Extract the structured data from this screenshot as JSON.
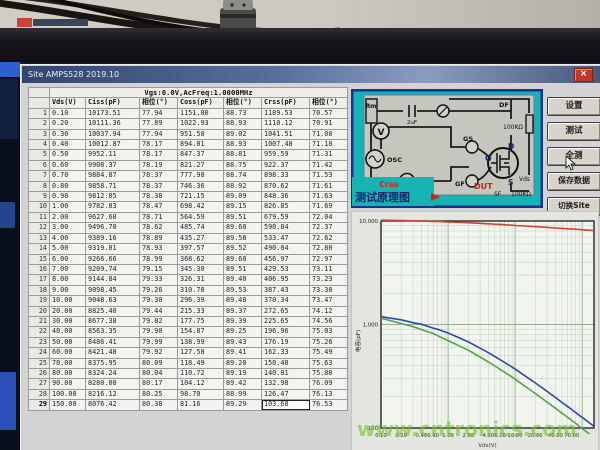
{
  "window": {
    "title": "Site AMPS528 2019.10",
    "close_label": "×"
  },
  "table": {
    "condition_header": "Vgs:0.0V,AcFreq:1.0000MHz",
    "columns": [
      "Vds(V)",
      "Ciss(pF)",
      "相位(°)",
      "Coss(pF)",
      "相位(°)",
      "Crss(pF)",
      "相位(°)"
    ],
    "rows": [
      [
        "0.10",
        "10173.51",
        "77.94",
        "1151.00",
        "88.73",
        "1189.53",
        "70.57"
      ],
      [
        "0.20",
        "10111.36",
        "77.89",
        "1022.93",
        "88.93",
        "1110.12",
        "70.91"
      ],
      [
        "0.30",
        "10037.94",
        "77.94",
        "951.58",
        "89.02",
        "1041.51",
        "71.08"
      ],
      [
        "0.40",
        "10012.87",
        "78.17",
        "894.01",
        "88.93",
        "1007.48",
        "71.18"
      ],
      [
        "0.50",
        "9952.11",
        "78.17",
        "847.37",
        "88.81",
        "959.59",
        "71.31"
      ],
      [
        "0.60",
        "9908.37",
        "78.19",
        "821.27",
        "88.75",
        "922.37",
        "71.42"
      ],
      [
        "0.70",
        "9884.87",
        "78.37",
        "777.98",
        "88.74",
        "898.33",
        "71.53"
      ],
      [
        "0.80",
        "9858.71",
        "78.37",
        "746.36",
        "88.92",
        "870.62",
        "71.61"
      ],
      [
        "0.90",
        "9812.05",
        "78.38",
        "721.15",
        "89.09",
        "848.36",
        "71.63"
      ],
      [
        "1.00",
        "9782.83",
        "78.47",
        "698.42",
        "89.15",
        "826.85",
        "71.69"
      ],
      [
        "2.00",
        "9627.68",
        "78.71",
        "564.59",
        "89.51",
        "679.59",
        "72.04"
      ],
      [
        "3.00",
        "9496.70",
        "78.62",
        "485.74",
        "89.60",
        "590.84",
        "72.37"
      ],
      [
        "4.00",
        "9389.16",
        "78.89",
        "435.27",
        "89.58",
        "533.47",
        "72.62"
      ],
      [
        "5.00",
        "9319.81",
        "78.93",
        "397.57",
        "89.52",
        "490.04",
        "72.80"
      ],
      [
        "6.00",
        "9266.66",
        "78.99",
        "368.62",
        "89.60",
        "456.97",
        "72.97"
      ],
      [
        "7.00",
        "9209.74",
        "79.15",
        "345.30",
        "89.51",
        "429.53",
        "73.11"
      ],
      [
        "8.00",
        "9144.84",
        "79.33",
        "326.31",
        "89.40",
        "406.95",
        "73.23"
      ],
      [
        "9.00",
        "9098.45",
        "79.26",
        "310.70",
        "89.53",
        "387.43",
        "73.38"
      ],
      [
        "10.00",
        "9048.63",
        "79.30",
        "296.39",
        "89.48",
        "370.34",
        "73.47"
      ],
      [
        "20.00",
        "8825.40",
        "79.44",
        "215.33",
        "89.37",
        "272.65",
        "74.12"
      ],
      [
        "30.00",
        "8677.38",
        "79.82",
        "177.75",
        "89.39",
        "225.65",
        "74.56"
      ],
      [
        "40.00",
        "8563.35",
        "79.90",
        "154.87",
        "89.25",
        "196.96",
        "75.03"
      ],
      [
        "50.00",
        "8486.41",
        "79.99",
        "138.99",
        "89.43",
        "176.19",
        "75.26"
      ],
      [
        "60.00",
        "8421.48",
        "79.92",
        "127.58",
        "89.41",
        "162.33",
        "75.49"
      ],
      [
        "70.00",
        "8375.95",
        "80.09",
        "118.49",
        "89.20",
        "150.48",
        "75.63"
      ],
      [
        "80.00",
        "8324.24",
        "80.04",
        "110.72",
        "89.19",
        "140.81",
        "75.88"
      ],
      [
        "90.00",
        "8280.08",
        "80.17",
        "104.12",
        "89.42",
        "132.98",
        "76.09"
      ],
      [
        "100.00",
        "8216.12",
        "80.25",
        "98.70",
        "88.99",
        "126.47",
        "76.13"
      ],
      [
        "150.00",
        "8076.42",
        "80.38",
        "81.16",
        "89.29",
        "103.68",
        "76.53"
      ]
    ],
    "selected_cell": {
      "row": 29,
      "column": "Crss(pF)"
    }
  },
  "buttons": {
    "settings": "设置",
    "test": "测试",
    "test_all": "全测",
    "save_data": "保存数据",
    "switch_site": "切换Site"
  },
  "diagram": {
    "caption_series": "Crss",
    "caption": "测试原理图",
    "labels": {
      "rm": "Rm",
      "cap": "2uF",
      "df": "DF",
      "r_top": "100KΩ",
      "osc": "OSC",
      "v_meter": "V",
      "a_meter": "A",
      "gs": "GS",
      "g": "G",
      "gf": "GF",
      "dut": "DUT",
      "d": "D",
      "s": "S",
      "vds": "Vds",
      "sf": "SF",
      "r_bottom": "100KΩ"
    },
    "colors": {
      "panel": "#15b3b3",
      "border": "#16338f",
      "dut_text": "#d42315"
    }
  },
  "chart_data": {
    "type": "line",
    "x": [
      0.1,
      0.2,
      0.3,
      0.4,
      0.5,
      0.6,
      0.7,
      0.8,
      0.9,
      1,
      2,
      3,
      4,
      5,
      6,
      7,
      8,
      9,
      10,
      20,
      30,
      40,
      50,
      60,
      70,
      80,
      90,
      100,
      150
    ],
    "series": [
      {
        "name": "Ciss",
        "color": "#c94438",
        "values": [
          10173.51,
          10111.36,
          10037.94,
          10012.87,
          9952.11,
          9908.37,
          9884.87,
          9858.71,
          9812.05,
          9782.83,
          9627.68,
          9496.7,
          9389.16,
          9319.81,
          9266.66,
          9209.74,
          9144.84,
          9098.45,
          9048.63,
          8825.4,
          8677.38,
          8563.35,
          8486.41,
          8421.48,
          8375.95,
          8324.24,
          8280.08,
          8216.12,
          8076.42
        ]
      },
      {
        "name": "Crss",
        "color": "#3545ae",
        "values": [
          1189.53,
          1110.12,
          1041.51,
          1007.48,
          959.59,
          922.37,
          898.33,
          870.62,
          848.36,
          826.85,
          679.59,
          590.84,
          533.47,
          490.04,
          456.97,
          429.53,
          406.95,
          387.43,
          370.34,
          272.65,
          225.65,
          196.96,
          176.19,
          162.33,
          150.48,
          140.81,
          132.98,
          126.47,
          103.68
        ]
      },
      {
        "name": "Coss",
        "color": "#55a24a",
        "values": [
          1151.0,
          1022.93,
          951.58,
          894.01,
          847.37,
          821.27,
          777.98,
          746.36,
          721.15,
          698.42,
          564.59,
          485.74,
          435.27,
          397.57,
          368.62,
          345.3,
          326.31,
          310.7,
          296.39,
          215.33,
          177.75,
          154.87,
          138.99,
          127.58,
          118.49,
          110.72,
          104.12,
          98.7,
          81.16
        ]
      }
    ],
    "xlabel": "Vds(V)",
    "ylabel": "电容(pF)",
    "xscale": "log",
    "yscale": "log",
    "xlim": [
      0.1,
      150
    ],
    "ylim": [
      100,
      10000
    ],
    "xticks": [
      "0.10",
      "0.20",
      "0.40",
      "0.60",
      "1.00",
      "2.00",
      "4.00",
      "6.00",
      "10.00",
      "20.00",
      "40.00",
      "70.00"
    ],
    "yticks": [
      "10,000",
      "1,000",
      "100"
    ],
    "grid": true,
    "legend": "none"
  },
  "watermark": "www.cntronics.com"
}
